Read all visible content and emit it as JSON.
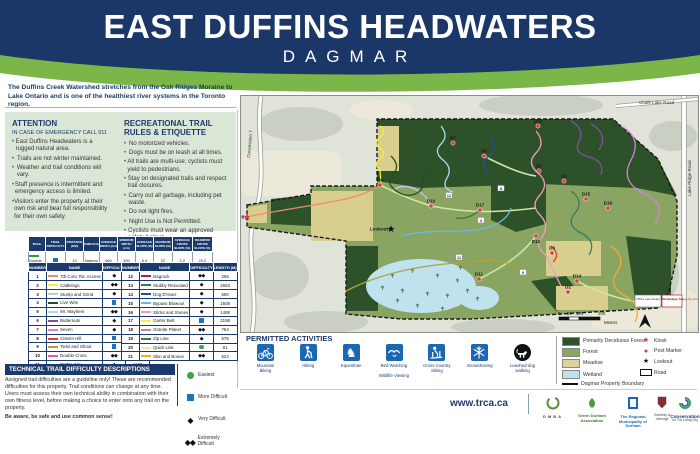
{
  "banner": {
    "title": "EAST DUFFINS HEADWATERS",
    "subtitle": "DAGMAR",
    "navy": "#1a3768",
    "green": "#7ab648"
  },
  "intro": "The Duffins Creek Watershed stretches from the Oak Ridges Moraine to Lake Ontario and is one of the healthiest river systems in the Toronto region.",
  "attention": {
    "title": "ATTENTION",
    "subtitle": "IN CASE OF EMERGENCY CALL 911",
    "items": [
      "East Duffins Headwaters is a rugged natural area.",
      "Trails are not winter maintained.",
      "Weather and trail conditions will vary.",
      "Staff presence is intermittent and emergency access is limited.",
      "Visitors enter the property at their own risk and bear full responsibility for their own safety."
    ]
  },
  "rules": {
    "title": "RECREATIONAL TRAIL RULES & ETIQUETTE",
    "items": [
      "No motorized vehicles.",
      "Dogs must be on leash at all times.",
      "All trails are multi-use; cyclists must yield to pedestrians.",
      "Stay on designated trails and respect trail closures.",
      "Carry out all garbage, including pet waste.",
      "Do not light fires.",
      "Night Use is Not Permitted.",
      "Cyclists must wear an approved safety helmet."
    ]
  },
  "access_table": {
    "headers": [
      "TRAIL",
      "TRAIL DIFFICULTY",
      "DISTANCE (KM)",
      "SURFACE",
      "AVERAGE WIDTH (cm)",
      "MINIMUM WIDTH (cm)",
      "AVERAGE SLOPE (%)",
      "MAXIMUM SLOPE (%)",
      "AVERAGE CROSS SLOPE (%)",
      "MAXIMUM CROSS SLOPE (%)"
    ],
    "row": {
      "name": "Double Track",
      "color": "#3a8e3a",
      "difficulty": "more",
      "distance": "13",
      "surface": "Natural",
      "values": [
        "460",
        "100",
        "6.4",
        "22",
        "3.2",
        "20.2"
      ]
    }
  },
  "trail_table": {
    "headers": [
      "NUMBER",
      "NAME",
      "DIFFICULTY",
      "LENGTH (M)"
    ],
    "left": [
      {
        "number": "1",
        "name": "7th Conc Rd. Access",
        "color": "#f08878",
        "difficulty": "very",
        "length": "1600"
      },
      {
        "number": "2",
        "name": "Cattlelogs",
        "color": "#f5ee3d",
        "difficulty": "extreme",
        "length": "742"
      },
      {
        "number": "3",
        "name": "Stump and Grind",
        "color": "#c7c3de",
        "difficulty": "very",
        "length": "1336"
      },
      {
        "number": "4",
        "name": "Live Wire",
        "color": "#23511e",
        "difficulty": "more",
        "length": "1330"
      },
      {
        "number": "5",
        "name": "Mr. Mayhem",
        "color": "#a8dcf0",
        "difficulty": "extreme",
        "length": "481"
      },
      {
        "number": "6",
        "name": "Butternuts",
        "color": "#7c52a1",
        "difficulty": "very",
        "length": "2061"
      },
      {
        "number": "7",
        "name": "Seven",
        "color": "#d183dd",
        "difficulty": "very",
        "length": "2822"
      },
      {
        "number": "8",
        "name": "Cistern Hill",
        "color": "#e23d2e",
        "difficulty": "more",
        "length": "492"
      },
      {
        "number": "9",
        "name": "Twist and Shout",
        "color": "#b0a437",
        "difficulty": "more",
        "length": "2233"
      },
      {
        "number": "10",
        "name": "Double Cross",
        "color": "#e957b2",
        "difficulty": "extreme",
        "length": "374"
      },
      {
        "number": "11",
        "name": "DMBA Way",
        "color": "#2e6b2e",
        "difficulty": "very",
        "length": "1139"
      }
    ],
    "right": [
      {
        "number": "12",
        "name": "Dagrock",
        "color": "#a3232f",
        "difficulty": "extreme",
        "length": "265"
      },
      {
        "number": "13",
        "name": "Stubby Relocated",
        "color": "#2e7d68",
        "difficulty": "very",
        "length": "2653"
      },
      {
        "number": "14",
        "name": "Dog D'Huez",
        "color": "#2a4d9b",
        "difficulty": "very",
        "length": "590"
      },
      {
        "number": "15",
        "name": "Bypass Blowout",
        "color": "#6cb7e4",
        "difficulty": "very",
        "length": "1608"
      },
      {
        "number": "16",
        "name": "Sticks and Stones",
        "color": "#f49ac1",
        "difficulty": "very",
        "length": "1488"
      },
      {
        "number": "17",
        "name": "Garter Belt",
        "color": "#f5ee3d",
        "difficulty": "more",
        "length": "2198"
      },
      {
        "number": "18",
        "name": "Granite Planet",
        "color": "#b08f96",
        "difficulty": "extreme",
        "length": "754"
      },
      {
        "number": "19",
        "name": "Zip Line",
        "color": "#3a7a3a",
        "difficulty": "very",
        "length": "678"
      },
      {
        "number": "20",
        "name": "Quick Link",
        "color": "#efe8a8",
        "difficulty": "easiest",
        "length": "81"
      },
      {
        "number": "21",
        "name": "Skin and Bones",
        "color": "#f5a83c",
        "difficulty": "extreme",
        "length": "524"
      }
    ]
  },
  "tech": {
    "title": "TECHNICAL TRAIL DIFFICULTY DESCRIPTIONS",
    "body": "Assigned trail difficulties are a guideline only! These are recommended difficulties for this property. Trail conditions can change at any time. Users must assess their own technical ability in combination with their own fitness level, before making a choice to enter onto any trail on the property.",
    "footer": "Be aware, be safe and use common sense!",
    "legend": [
      {
        "symbol": "easiest",
        "label": "Easiest"
      },
      {
        "symbol": "more",
        "label": "More Difficult"
      },
      {
        "symbol": "very",
        "label": "Very Difficult"
      },
      {
        "symbol": "extreme",
        "label": "Extremely Difficult"
      }
    ]
  },
  "activities": {
    "title": "PERMITTED ACTIVITIES",
    "items": [
      {
        "icon": "mountain-bike-icon",
        "label": "Mountain/Biking"
      },
      {
        "icon": "hiking-icon",
        "label": "Hiking"
      },
      {
        "icon": "equestrian-icon",
        "label": "Equestrian"
      },
      {
        "icon": "bird-watching-icon",
        "label": "Bird Watching//Wildlife Viewing"
      },
      {
        "icon": "xc-ski-icon",
        "label": "Cross Country/Skiing"
      },
      {
        "icon": "snowshoe-icon",
        "label": "Snowshoeing"
      },
      {
        "icon": "leashed-dog-icon",
        "label": "Leashed-dog/walking",
        "dark": true
      }
    ]
  },
  "map": {
    "roads": {
      "west": "Concession 7",
      "east": "Lake Ridge Road",
      "north": "Chalk Lake Road"
    },
    "lookout": "Lookout",
    "markers": [
      {
        "id": "D1",
        "x": 420,
        "y": 209,
        "type": "post"
      },
      {
        "id": "D2",
        "x": 327,
        "y": 196,
        "type": "post"
      },
      {
        "id": "D3",
        "x": 311,
        "y": 157,
        "type": "post"
      },
      {
        "id": "D4",
        "x": 323,
        "y": 85,
        "type": "post"
      },
      {
        "id": "D5",
        "x": 298,
        "y": 75,
        "type": "post"
      },
      {
        "id": "D6",
        "x": 243,
        "y": 60,
        "type": "post"
      },
      {
        "id": "D7",
        "x": 212,
        "y": 47,
        "type": "post"
      },
      {
        "id": "D8",
        "x": 6,
        "y": 121,
        "type": "kiosk",
        "side": "left"
      },
      {
        "id": "D9",
        "x": 139,
        "y": 89,
        "type": "post"
      },
      {
        "id": "D10",
        "x": 190,
        "y": 110,
        "type": "post"
      },
      {
        "id": "D11",
        "x": 238,
        "y": 183,
        "type": "post"
      },
      {
        "id": "D12",
        "x": 295,
        "y": 140,
        "type": "post",
        "side": "below"
      },
      {
        "id": "D13",
        "x": 297,
        "y": 30,
        "type": "post"
      },
      {
        "id": "D14",
        "x": 336,
        "y": 185,
        "type": "post"
      },
      {
        "id": "D15",
        "x": 345,
        "y": 103,
        "type": "post"
      },
      {
        "id": "D16",
        "x": 367,
        "y": 112,
        "type": "post"
      },
      {
        "id": "D17",
        "x": 239,
        "y": 114,
        "type": "post"
      },
      {
        "id": "Lookout",
        "x": 150,
        "y": 133,
        "type": "lookout",
        "side": "left"
      }
    ],
    "chips": [
      {
        "n": "12",
        "x": 208,
        "y": 100
      },
      {
        "n": "11",
        "x": 218,
        "y": 162
      },
      {
        "n": "8",
        "x": 260,
        "y": 93
      },
      {
        "n": "9",
        "x": 282,
        "y": 177
      },
      {
        "n": "3",
        "x": 240,
        "y": 125
      }
    ],
    "scale": {
      "t0": "0",
      "t1": "50",
      "t2": "100",
      "t3": "200",
      "unit": "Meters"
    },
    "inset": {
      "box1": "TRCA Lake Ridge Rd Uxbridge Twp",
      "box2": "Emergency Assembly Area"
    },
    "legend_areas": [
      {
        "label": "Primarily Deciduous Forest",
        "color": "#2d5128"
      },
      {
        "label": "Forest",
        "color": "#8aa562"
      },
      {
        "label": "Meadow",
        "color": "#d8d49a"
      },
      {
        "label": "Wetland",
        "color": "#bfe2ef"
      },
      {
        "label": "Dagmar Property Boundary",
        "color": "line"
      }
    ],
    "legend_points": [
      {
        "label": "Kiosk",
        "symbol": "red-star"
      },
      {
        "label": "Post Marker",
        "symbol": "red-circle"
      },
      {
        "label": "Lookout",
        "symbol": "black-star"
      },
      {
        "label": "Road",
        "symbol": "road"
      }
    ]
  },
  "footer": {
    "website": "www.trca.ca",
    "logos": [
      {
        "name": "DMBA",
        "sub": ""
      },
      {
        "name": "Green Durham Association",
        "sub": ""
      },
      {
        "name": "The Regional Municipality of Durham",
        "sub": ""
      },
      {
        "name": "Township of Uxbridge",
        "sub": ""
      },
      {
        "name": "Conservation",
        "sub": "for The Living City"
      }
    ]
  }
}
